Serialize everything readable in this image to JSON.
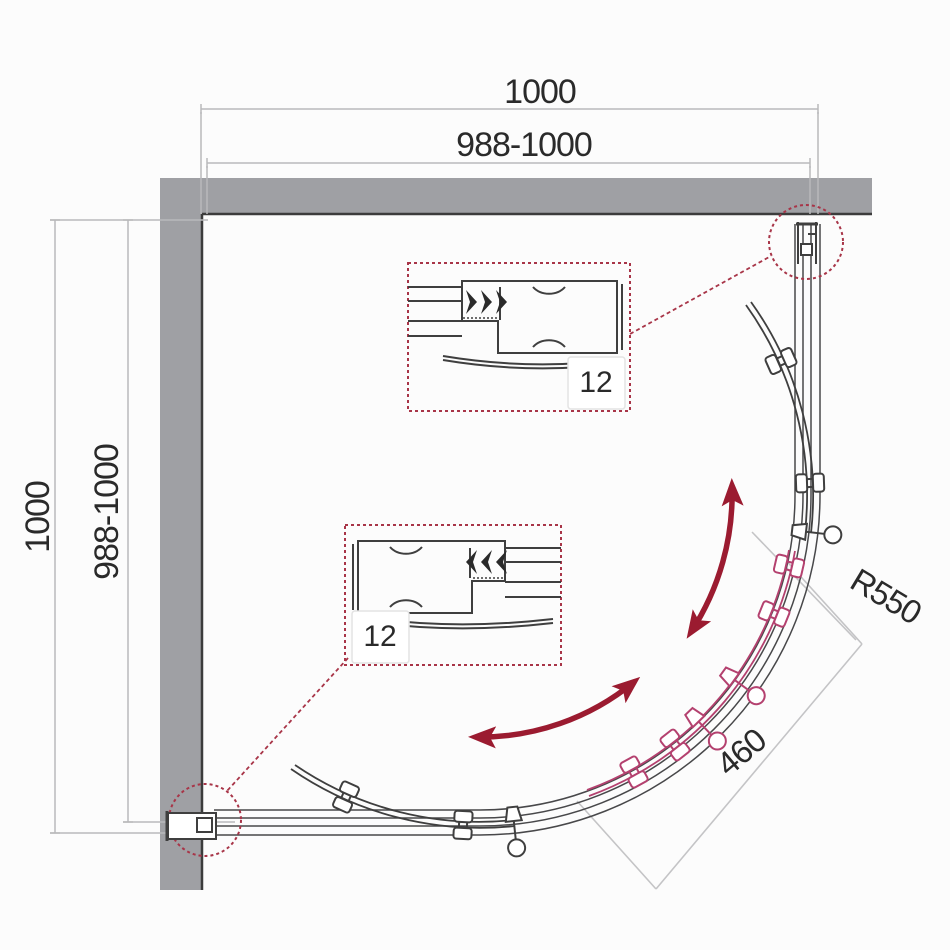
{
  "diagram": {
    "type": "technical-drawing",
    "subject": "quadrant shower enclosure installation diagram, top view",
    "units": "mm",
    "overall_width": 1000,
    "overall_height": 1000,
    "adjustment_range": "988-1000",
    "door_radius": 550,
    "door_opening": 460,
    "wall_profile_adjustment": 12
  },
  "labels": {
    "top_width": "1000",
    "top_width_adjust": "988-1000",
    "left_height": "1000",
    "left_height_adjust": "988-1000",
    "radius": "R550",
    "door_opening": "460",
    "profile_detail_top": "12",
    "profile_detail_bottom": "12"
  },
  "colors": {
    "wall_fill": "#9fa0a4",
    "outline": "#3f3f3f",
    "dimension_line": "#b9b9bb",
    "annotation_line": "#c4c4c6",
    "text": "#2a2a2a",
    "callout_red": "#a83548",
    "door_open_magenta": "#b4416f",
    "arrow_maroon": "#9b1b30",
    "background": "#fcfcfc"
  }
}
